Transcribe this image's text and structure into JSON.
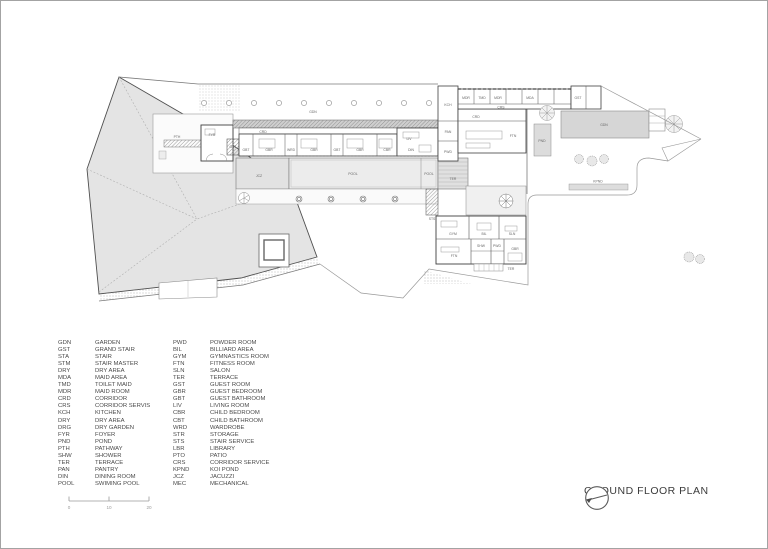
{
  "title_block": {
    "label": "GROUND FLOOR PLAN"
  },
  "scale_bar": {
    "ticks": [
      "0",
      "10",
      "20"
    ]
  },
  "legend": {
    "left": [
      {
        "code": "GDN",
        "name": "GARDEN"
      },
      {
        "code": "GST",
        "name": "GRAND STAIR"
      },
      {
        "code": "STA",
        "name": "STAIR"
      },
      {
        "code": "STM",
        "name": "STAIR MASTER"
      },
      {
        "code": "DRY",
        "name": "DRY AREA"
      },
      {
        "code": "MDA",
        "name": "MAID AREA"
      },
      {
        "code": "TMD",
        "name": "TOILET MAID"
      },
      {
        "code": "MDR",
        "name": "MAID ROOM"
      },
      {
        "code": "CRD",
        "name": "CORRIDOR"
      },
      {
        "code": "CRS",
        "name": "CORRIDOR SERVIS"
      },
      {
        "code": "KCH",
        "name": "KITCHEN"
      },
      {
        "code": "DRY",
        "name": "DRY AREA"
      },
      {
        "code": "DRG",
        "name": "DRY GARDEN"
      },
      {
        "code": "FYR",
        "name": "FOYER"
      },
      {
        "code": "PND",
        "name": "POND"
      },
      {
        "code": "PTH",
        "name": "PATHWAY"
      },
      {
        "code": "SHW",
        "name": "SHOWER"
      },
      {
        "code": "TER",
        "name": "TERRACE"
      },
      {
        "code": "PAN",
        "name": "PANTRY"
      },
      {
        "code": "DIN",
        "name": "DINING ROOM"
      },
      {
        "code": "POOL",
        "name": "SWIMING POOL"
      }
    ],
    "right": [
      {
        "code": "PWD",
        "name": "POWDER ROOM"
      },
      {
        "code": "BIL",
        "name": "BILLIARD AREA"
      },
      {
        "code": "GYM",
        "name": "GYMNASTICS ROOM"
      },
      {
        "code": "FTN",
        "name": "FITNESS ROOM"
      },
      {
        "code": "SLN",
        "name": "SALON"
      },
      {
        "code": "TER",
        "name": "TERRACE"
      },
      {
        "code": "GST",
        "name": "GUEST ROOM"
      },
      {
        "code": "GBR",
        "name": "GUEST BEDROOM"
      },
      {
        "code": "GBT",
        "name": "GUEST BATHROOM"
      },
      {
        "code": "LIV",
        "name": "LIVING ROOM"
      },
      {
        "code": "CBR",
        "name": "CHILD BEDROOM"
      },
      {
        "code": "CBT",
        "name": "CHILD BATHROOM"
      },
      {
        "code": "WRD",
        "name": "WARDROBE"
      },
      {
        "code": "STR",
        "name": "STORAGE"
      },
      {
        "code": "STS",
        "name": "STAIR SERVICE"
      },
      {
        "code": "LBR",
        "name": "LIBRARY"
      },
      {
        "code": "PTO",
        "name": "PATIO"
      },
      {
        "code": "CRS",
        "name": "CORRIDOR SERVICE"
      },
      {
        "code": "KPND",
        "name": "KOI POND"
      },
      {
        "code": "JCZ",
        "name": "JACUZZI"
      },
      {
        "code": "MEC",
        "name": "MECHANICAL"
      }
    ]
  },
  "plan": {
    "room_labels": {
      "gdn": "GDN",
      "pth": "PTH",
      "fyr": "FYR",
      "gst": "GST",
      "crd": "CRD",
      "crs": "CRS",
      "gbt": "GBT",
      "gbr": "GBR",
      "wrd": "WRD",
      "cbr": "CBR",
      "pool": "POOL",
      "jcz": "JCZ",
      "ter": "TER",
      "din": "DIN",
      "liv": "LIV",
      "kch": "KCH",
      "pan": "PAN",
      "pwd": "PWD",
      "mdr": "MDR",
      "tmd": "TMD",
      "mda": "MDA",
      "pnd": "PND",
      "kpnd": "KPND",
      "gym": "GYM",
      "bil": "BIL",
      "sln": "SLN",
      "ftn": "FTN",
      "shw": "SHW",
      "sts": "STS"
    }
  },
  "colors": {
    "roof_fill": "#e4e4e4",
    "garden_fill": "#d6d6d6",
    "pool_fill": "#ececec",
    "jacuzzi_fill": "#e2e2e2",
    "wall_line": "#3f3f3f",
    "boundary_line": "#999999",
    "text": "#4a4a4a"
  }
}
